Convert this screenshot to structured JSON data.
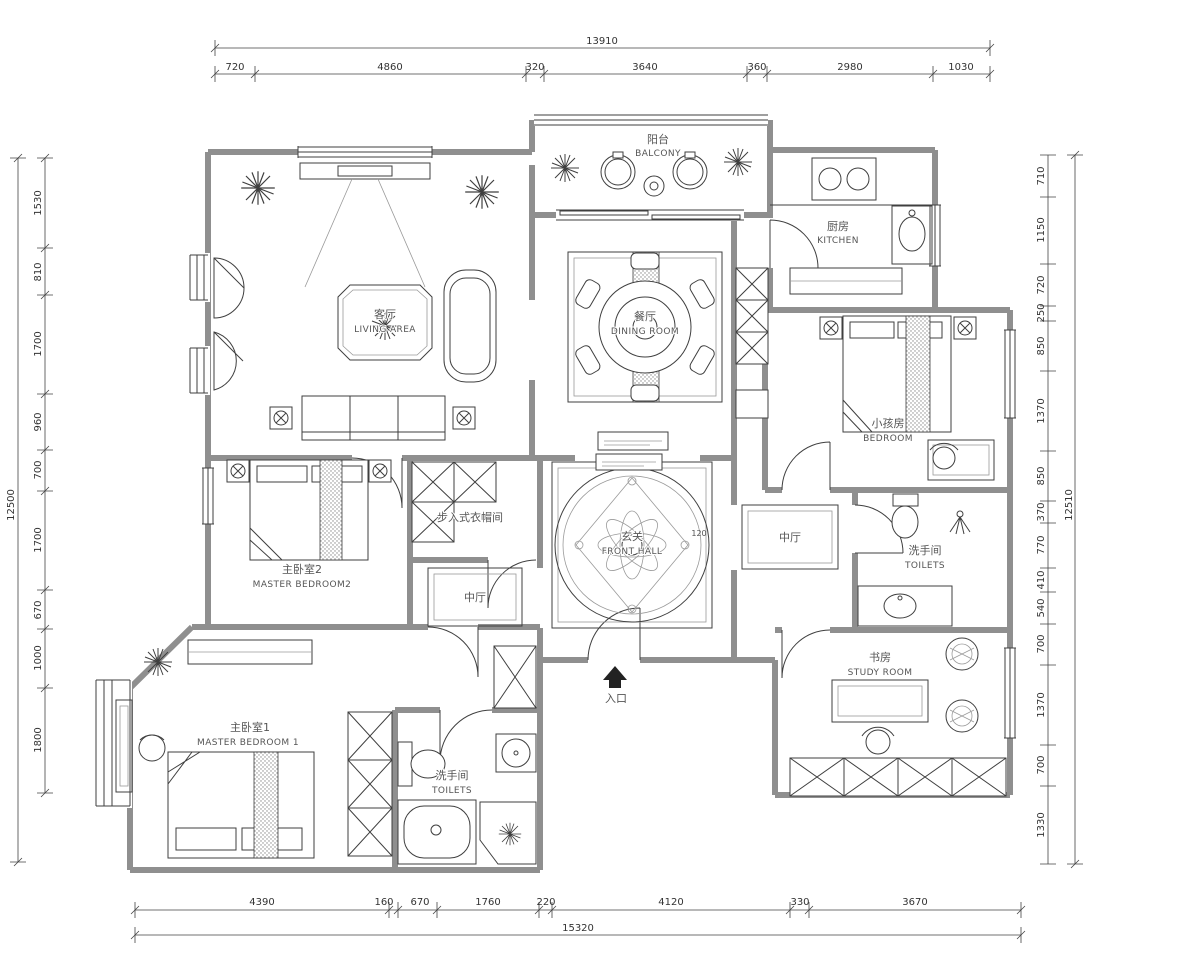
{
  "drawing": {
    "type": "apartment floor plan",
    "style": "CAD line drawing"
  },
  "dims": {
    "top": {
      "total": "13910",
      "segments": [
        "720",
        "4860",
        "320",
        "3640",
        "360",
        "2980",
        "1030"
      ]
    },
    "bottom": {
      "total": "15320",
      "segments": [
        "4390",
        "160",
        "670",
        "1760",
        "220",
        "4120",
        "330",
        "3670"
      ]
    },
    "left": {
      "total": "12500",
      "segments": [
        "1530",
        "810",
        "1700",
        "960",
        "700",
        "1700",
        "670",
        "1000",
        "1800"
      ]
    },
    "right": {
      "total": "12510",
      "segments": [
        "710",
        "1150",
        "720",
        "250",
        "850",
        "1370",
        "850",
        "370",
        "770",
        "410",
        "540",
        "700",
        "1370",
        "700",
        "1330"
      ]
    }
  },
  "rooms": {
    "balcony": {
      "zh": "阳台",
      "en": "BALCONY"
    },
    "living": {
      "zh": "客厅",
      "en": "LIVING AREA"
    },
    "dining": {
      "zh": "餐厅",
      "en": "DINING ROOM"
    },
    "kitchen": {
      "zh": "厨房",
      "en": "KITCHEN"
    },
    "child_bedroom": {
      "zh": "小孩房",
      "en": "BEDROOM"
    },
    "master_bedroom2": {
      "zh": "主卧室2",
      "en": "MASTER BEDROOM2"
    },
    "walkin_closet": {
      "zh": "步入式衣帽间",
      "en": ""
    },
    "front_hall": {
      "zh": "玄关",
      "en": "FRONT HALL"
    },
    "mid_hall_left": {
      "zh": "中厅",
      "en": ""
    },
    "mid_hall_right": {
      "zh": "中厅",
      "en": ""
    },
    "toilets_right": {
      "zh": "洗手间",
      "en": "TOILETS"
    },
    "study": {
      "zh": "书房",
      "en": "STUDY ROOM"
    },
    "master_bedroom1": {
      "zh": "主卧室1",
      "en": "MASTER BEDROOM 1"
    },
    "toilets_bottom": {
      "zh": "洗手间",
      "en": "TOILETS"
    },
    "entrance": {
      "zh": "入口",
      "en": ""
    }
  },
  "annotations": {
    "front_hall_dim": "120"
  },
  "colors": {
    "background": "#ffffff",
    "wall": "#8f8f8f",
    "line": "#3f3f3f",
    "text": "#555555",
    "dim_text": "#333333"
  }
}
